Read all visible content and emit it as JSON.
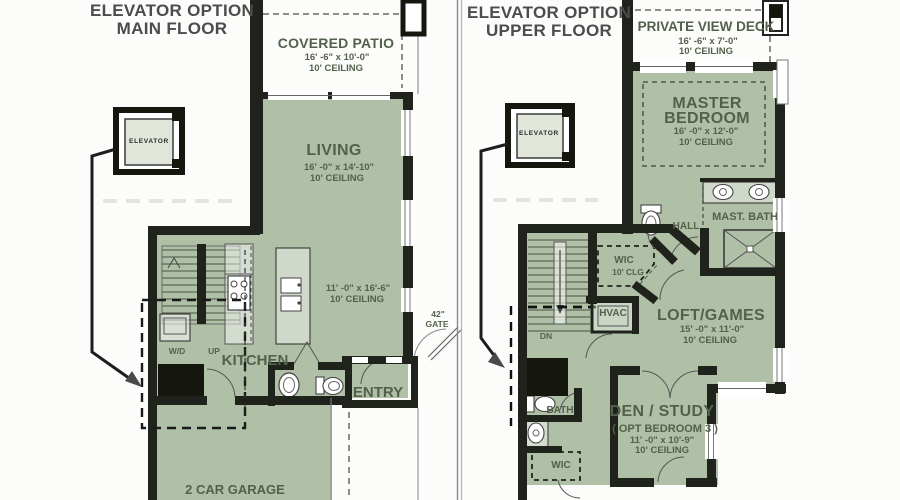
{
  "left_plan": {
    "title_line1": "ELEVATOR OPTION",
    "title_line2": "MAIN FLOOR",
    "covered_patio": {
      "name": "COVERED PATIO",
      "dims": "16' -6\" x 10'-0\"",
      "ceiling": "10' CEILING"
    },
    "living": {
      "name": "LIVING",
      "dims": "16' -0\" x 14'-10\"",
      "ceiling": "10' CEILING"
    },
    "kitchen": {
      "name": "KITCHEN",
      "dims": "11' -0\" x 16'-6\"",
      "ceiling": "10' CEILING"
    },
    "entry": {
      "name": "ENTRY"
    },
    "garage": {
      "name": "2 CAR GARAGE"
    },
    "elevator": {
      "name": "ELEVATOR"
    },
    "wd": "W/D",
    "up": "UP",
    "gate_line1": "42\"",
    "gate_line2": "GATE"
  },
  "right_plan": {
    "title_line1": "ELEVATOR OPTION",
    "title_line2": "UPPER FLOOR",
    "deck": {
      "name": "PRIVATE VIEW DECK",
      "dims": "16' -6\" x 7'-0\"",
      "ceiling": "10' CEILING"
    },
    "master_bedroom": {
      "name_line1": "MASTER",
      "name_line2": "BEDROOM",
      "dims": "16' -0\" x 12'-0\"",
      "ceiling": "10' CEILING"
    },
    "master_bath": {
      "name": "MAST. BATH"
    },
    "hall": {
      "name": "HALL"
    },
    "wic_upper": {
      "name": "WIC",
      "ceiling": "10' CLG"
    },
    "hvac": {
      "name": "HVAC"
    },
    "loft": {
      "name": "LOFT/GAMES",
      "dims": "15' -0\" x 11'-0\"",
      "ceiling": "10' CEILING"
    },
    "den": {
      "name": "DEN / STUDY",
      "subtitle": "( OPT BEDROOM 3 )",
      "dims": "11' -0\" x 10'-9\"",
      "ceiling": "10' CEILING"
    },
    "bath": {
      "name": "BATH"
    },
    "wic_lower": {
      "name": "WIC"
    },
    "dn": "DN",
    "elevator": {
      "name": "ELEVATOR"
    }
  },
  "colors": {
    "room_fill": "#afc0a7",
    "wall": "#20231c",
    "label_text": "#53614c",
    "title_text": "#4c4c4c"
  }
}
